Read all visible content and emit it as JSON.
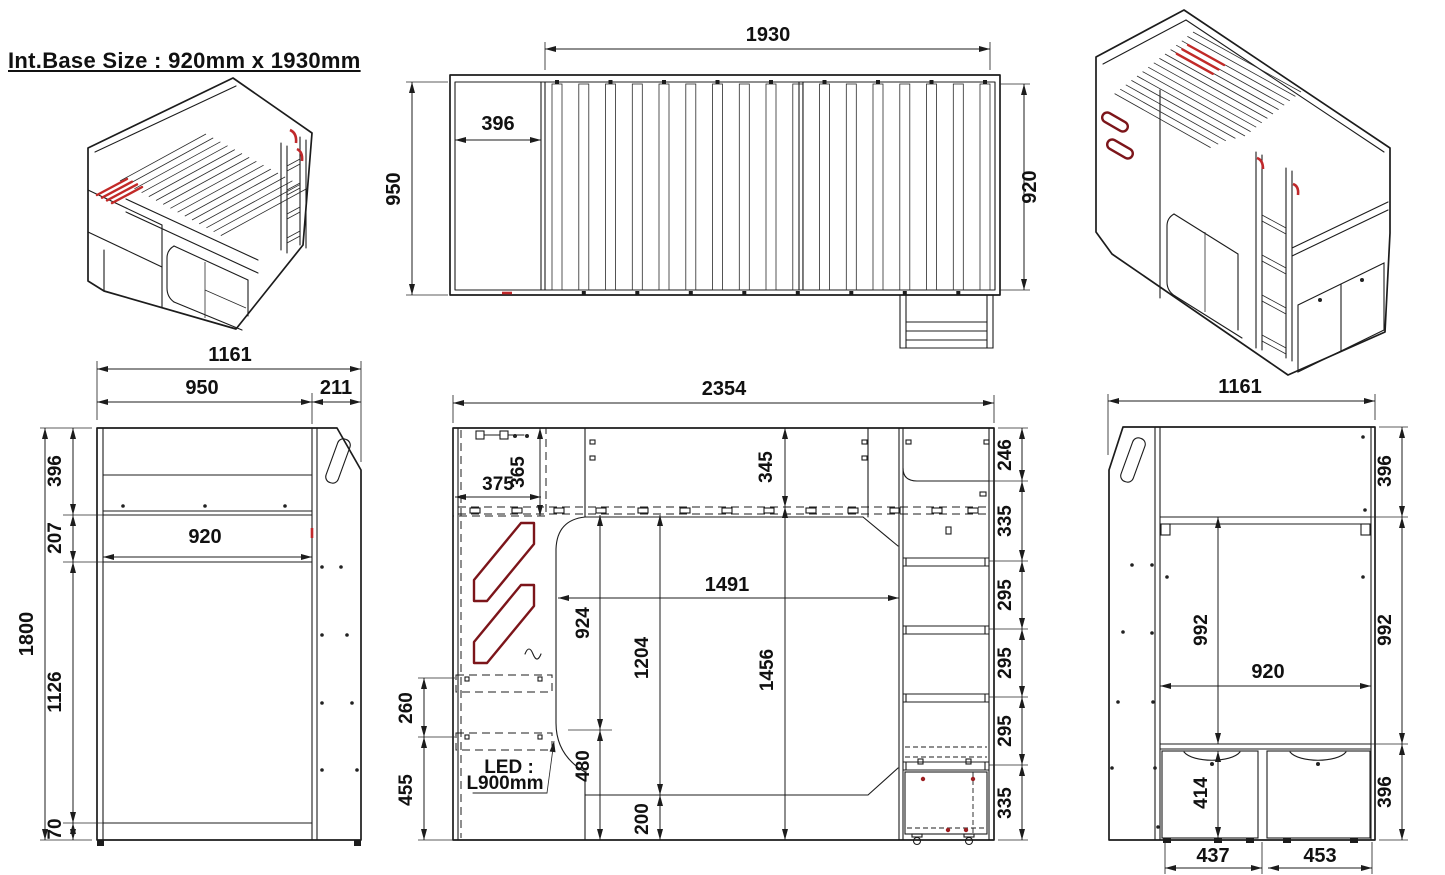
{
  "title": "Int.Base Size : 920mm x 1930mm",
  "plan_view": {
    "length": "1930",
    "inner": "396",
    "depth_left": "950",
    "depth_right": "920"
  },
  "side_left": {
    "overall_w": "1161",
    "body_w": "950",
    "panel_w": "211",
    "top_h": "396",
    "gap_h": "207",
    "overall_h": "1800",
    "lower_h": "1126",
    "base_h": "70",
    "inner_w": "920"
  },
  "front": {
    "overall_w": "2354",
    "cab_w": "375",
    "cab_h": "365",
    "deck_h": "345",
    "seg_246": "246",
    "seg_335a": "335",
    "seg_295a": "295",
    "seg_295b": "295",
    "seg_295c": "295",
    "seg_335b": "335",
    "clear_h": "924",
    "open_h": "1204",
    "side_h": "1456",
    "open_w": "1491",
    "led_h": "480",
    "base_h": "200",
    "shelf_h": "260",
    "lower_h": "455",
    "led1": "LED :",
    "led2": "L900mm"
  },
  "side_right": {
    "overall_w": "1161",
    "top_h": "396",
    "inner_h": "992",
    "right_h": "992",
    "inner_w": "920",
    "drawer_h": "414",
    "bottom_h": "396",
    "d1_w": "437",
    "d2_w": "453"
  }
}
